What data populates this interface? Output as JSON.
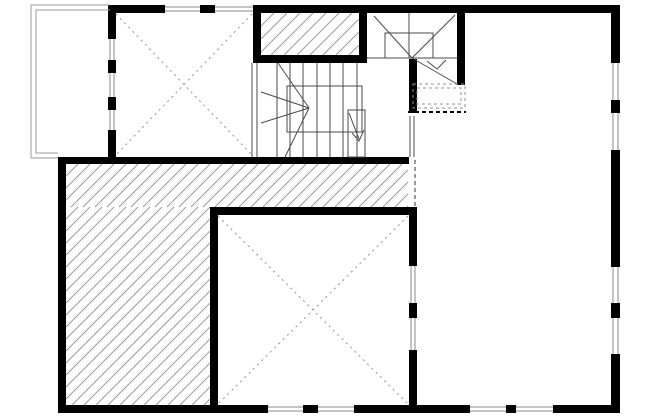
{
  "plan": {
    "width": 650,
    "height": 416,
    "colors": {
      "background": "#ffffff",
      "wall": "#000000",
      "thin": "#4a4a4a",
      "hatch": "#9b9b9b",
      "window_line": "#8a8a8a",
      "dash": "#909090",
      "deck": "#9a9a9a"
    },
    "walls": [
      [
        108,
        5,
        57,
        8
      ],
      [
        200,
        5,
        15,
        8
      ],
      [
        367,
        5,
        253,
        8
      ],
      [
        611,
        5,
        9,
        58
      ],
      [
        611,
        100,
        9,
        13
      ],
      [
        611,
        150,
        9,
        117
      ],
      [
        611,
        303,
        9,
        15
      ],
      [
        611,
        354,
        9,
        59
      ],
      [
        58,
        405,
        210,
        8
      ],
      [
        303,
        405,
        15,
        8
      ],
      [
        354,
        405,
        116,
        8
      ],
      [
        506,
        405,
        10,
        8
      ],
      [
        553,
        405,
        67,
        8
      ],
      [
        58,
        157,
        8,
        256
      ],
      [
        58,
        157,
        351,
        7
      ],
      [
        108,
        5,
        8,
        34
      ],
      [
        108,
        60,
        8,
        13
      ],
      [
        108,
        97,
        8,
        13
      ],
      [
        108,
        130,
        8,
        28
      ],
      [
        210,
        207,
        8,
        206
      ],
      [
        210,
        207,
        207,
        8
      ],
      [
        409,
        215,
        8,
        51
      ],
      [
        409,
        303,
        8,
        15
      ],
      [
        409,
        350,
        8,
        63
      ],
      [
        457,
        13,
        8,
        72
      ],
      [
        409,
        59,
        8,
        54
      ],
      [
        253,
        5,
        114,
        8
      ],
      [
        253,
        55,
        114,
        8
      ],
      [
        253,
        5,
        8,
        58
      ],
      [
        359,
        5,
        8,
        58
      ]
    ],
    "hatch_areas": [
      {
        "x": 66,
        "y": 164,
        "w": 342,
        "h": 43,
        "step": 12,
        "name": "hatched-floor-band"
      },
      {
        "x": 66,
        "y": 207,
        "w": 144,
        "h": 198,
        "step": 12,
        "name": "hatched-floor-left"
      },
      {
        "x": 261,
        "y": 13,
        "w": 98,
        "h": 42,
        "step": 13,
        "name": "chimney-hatch"
      }
    ],
    "windows": [
      {
        "x": 165,
        "y": 5,
        "w": 35,
        "h": 8,
        "orient": "h"
      },
      {
        "x": 215,
        "y": 5,
        "w": 38,
        "h": 8,
        "orient": "h"
      },
      {
        "x": 108,
        "y": 39,
        "w": 8,
        "h": 21,
        "orient": "v"
      },
      {
        "x": 108,
        "y": 73,
        "w": 8,
        "h": 24,
        "orient": "v"
      },
      {
        "x": 108,
        "y": 110,
        "w": 8,
        "h": 20,
        "orient": "v"
      },
      {
        "x": 611,
        "y": 63,
        "w": 9,
        "h": 37,
        "orient": "v"
      },
      {
        "x": 611,
        "y": 113,
        "w": 9,
        "h": 37,
        "orient": "v"
      },
      {
        "x": 611,
        "y": 267,
        "w": 9,
        "h": 36,
        "orient": "v"
      },
      {
        "x": 611,
        "y": 318,
        "w": 9,
        "h": 36,
        "orient": "v"
      },
      {
        "x": 409,
        "y": 266,
        "w": 8,
        "h": 37,
        "orient": "v"
      },
      {
        "x": 409,
        "y": 318,
        "w": 8,
        "h": 32,
        "orient": "v"
      },
      {
        "x": 268,
        "y": 405,
        "w": 35,
        "h": 8,
        "orient": "h"
      },
      {
        "x": 318,
        "y": 405,
        "w": 36,
        "h": 8,
        "orient": "h"
      },
      {
        "x": 470,
        "y": 405,
        "w": 36,
        "h": 8,
        "orient": "h"
      },
      {
        "x": 516,
        "y": 405,
        "w": 37,
        "h": 8,
        "orient": "h"
      }
    ],
    "thin_rects": [
      {
        "x": 287,
        "y": 86,
        "w": 75,
        "h": 46,
        "name": "stair1-inner-outline"
      },
      {
        "x": 348,
        "y": 110,
        "w": 17,
        "h": 47,
        "name": "stair1-newel-box"
      },
      {
        "x": 385,
        "y": 33,
        "w": 48,
        "h": 25,
        "name": "stair2-landing-outline"
      }
    ],
    "dashed_rects": [
      {
        "x": 413,
        "y": 84,
        "w": 52,
        "h": 24,
        "name": "stair2-flight-above-outer"
      },
      {
        "x": 417,
        "y": 88,
        "w": 44,
        "h": 16,
        "name": "stair2-flight-above-inner"
      }
    ],
    "polylines": [
      {
        "points": "110,5 31,5 31,158 58,158",
        "color": "#9a9a9a",
        "name": "deck-outline-outer"
      },
      {
        "points": "110,10 36,10 36,153 58,153",
        "color": "#9a9a9a",
        "name": "deck-outline-inner"
      },
      {
        "points": "352,133 359,141 364,130",
        "color": "#4a4a4a",
        "name": "stair1-arrowhead"
      },
      {
        "points": "427,61 437,69 446,60",
        "color": "#4a4a4a",
        "name": "stair2-arrowhead"
      }
    ],
    "lines": [
      {
        "x1": 116,
        "y1": 14,
        "x2": 252,
        "y2": 155,
        "dash": "2,4",
        "color": "#909090",
        "name": "room1-cross-diagonal-a"
      },
      {
        "x1": 252,
        "y1": 14,
        "x2": 116,
        "y2": 155,
        "dash": "2,4",
        "color": "#909090",
        "name": "room1-cross-diagonal-b"
      },
      {
        "x1": 218,
        "y1": 216,
        "x2": 408,
        "y2": 404,
        "dash": "2,4",
        "color": "#909090",
        "name": "room2-cross-diagonal-a"
      },
      {
        "x1": 408,
        "y1": 216,
        "x2": 218,
        "y2": 404,
        "dash": "2,4",
        "color": "#909090",
        "name": "room2-cross-diagonal-b"
      },
      {
        "x1": 252,
        "y1": 63,
        "x2": 252,
        "y2": 157,
        "name": "stair1-left-edge-a"
      },
      {
        "x1": 257,
        "y1": 63,
        "x2": 257,
        "y2": 157,
        "name": "stair1-left-edge-b"
      },
      {
        "x1": 277,
        "y1": 63,
        "x2": 277,
        "y2": 157,
        "name": "stair1-tread"
      },
      {
        "x1": 290,
        "y1": 63,
        "x2": 290,
        "y2": 157,
        "name": "stair1-tread"
      },
      {
        "x1": 303,
        "y1": 63,
        "x2": 303,
        "y2": 157,
        "name": "stair1-tread"
      },
      {
        "x1": 317,
        "y1": 63,
        "x2": 317,
        "y2": 157,
        "name": "stair1-tread"
      },
      {
        "x1": 330,
        "y1": 63,
        "x2": 330,
        "y2": 157,
        "name": "stair1-tread"
      },
      {
        "x1": 343,
        "y1": 63,
        "x2": 343,
        "y2": 157,
        "name": "stair1-tread"
      },
      {
        "x1": 357,
        "y1": 63,
        "x2": 357,
        "y2": 157,
        "name": "stair1-tread"
      },
      {
        "x1": 309,
        "y1": 108,
        "x2": 278,
        "y2": 63,
        "name": "stair1-winder"
      },
      {
        "x1": 309,
        "y1": 108,
        "x2": 261,
        "y2": 92,
        "name": "stair1-winder"
      },
      {
        "x1": 309,
        "y1": 108,
        "x2": 261,
        "y2": 123,
        "name": "stair1-winder"
      },
      {
        "x1": 309,
        "y1": 108,
        "x2": 285,
        "y2": 157,
        "name": "stair1-winder"
      },
      {
        "x1": 349,
        "y1": 113,
        "x2": 359,
        "y2": 139,
        "name": "stair1-arrow-shaft"
      },
      {
        "x1": 367,
        "y1": 58,
        "x2": 457,
        "y2": 58,
        "name": "stair2-landing-line"
      },
      {
        "x1": 409,
        "y1": 13,
        "x2": 409,
        "y2": 58,
        "name": "stair2-left-line"
      },
      {
        "x1": 412,
        "y1": 58,
        "x2": 374,
        "y2": 16,
        "name": "stair2-winder"
      },
      {
        "x1": 412,
        "y1": 58,
        "x2": 455,
        "y2": 15,
        "name": "stair2-winder"
      },
      {
        "x1": 412,
        "y1": 58,
        "x2": 457,
        "y2": 84,
        "name": "stair2-winder"
      },
      {
        "x1": 410,
        "y1": 116,
        "x2": 410,
        "y2": 157,
        "name": "opening-double-line-a"
      },
      {
        "x1": 414,
        "y1": 116,
        "x2": 414,
        "y2": 157,
        "name": "opening-double-line-b"
      },
      {
        "x1": 415,
        "y1": 160,
        "x2": 415,
        "y2": 206,
        "dash": "4,3",
        "color": "#333333",
        "name": "dashed-opening-line"
      },
      {
        "x1": 408,
        "y1": 112,
        "x2": 466,
        "y2": 112,
        "dash": "4,3",
        "color": "#000000",
        "w": 2,
        "name": "dashed-threshold-line"
      }
    ]
  }
}
